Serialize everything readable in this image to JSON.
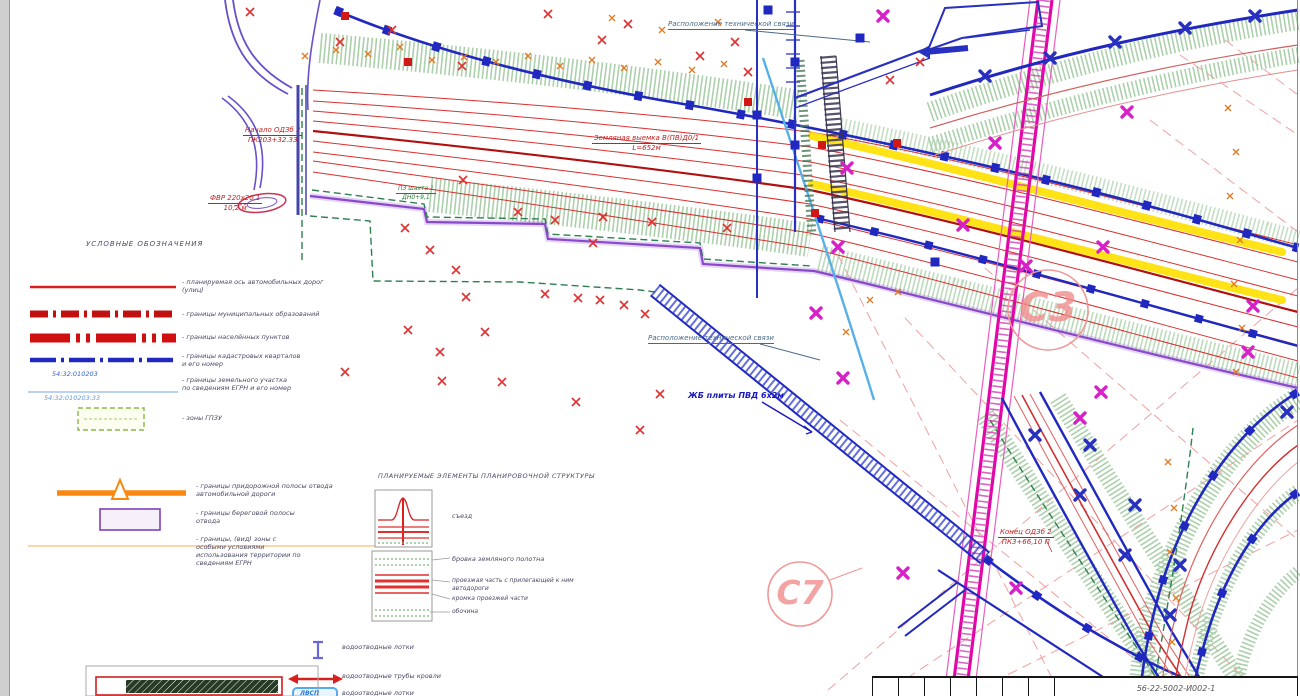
{
  "title_block": {
    "doc_number": "56-22-5002-И002-1"
  },
  "map": {
    "tech_top": "Расположение технической связи",
    "tech_mid": "Расположение технической связи",
    "start_a": "Начало ОДЗб 2",
    "start_b": "ПК203+32.33",
    "fvr_a": "ФВР 220х20,1",
    "fvr_b": "10,2 м",
    "shaft_a": "ПЗ шахта 1",
    "shaft_b": "ДН0+9,1",
    "exc_a": "Земляная выемка В(ПВ)Д0/1",
    "exc_b": "L=652м",
    "slabs": "ЖБ плиты ПВД 6х2м",
    "end_a": "Конец ОДЗб 2",
    "end_b": "ПК3+66,10 П",
    "zone_c3": "C3",
    "zone_c7": "C7"
  },
  "legend1": {
    "title": "УСЛОВНЫЕ ОБОЗНАЧЕНИЯ",
    "r1a": "- планируемая ось автомобильных дорог",
    "r1b": "(улиц)",
    "r2": "- границы муниципальных образований",
    "r3": "- границы населённых пунктов",
    "r4a": "- границы кадастровых кварталов",
    "r4b": "и его номер",
    "r5a": "- границы земельного участка",
    "r5b": "по  сведениям ЕГРН и его номер",
    "r6": "- зоны ГПЗУ",
    "cad_quarter": "54:32:010203",
    "cad_parcel": "54:32:010203:33"
  },
  "legend2": {
    "r1a": "- границы придорожной полосы отвода",
    "r1b": "автомобильной дороги",
    "r2a": "- границы береговой полосы",
    "r2b": "отвода",
    "r3a": "- границы, (вид) зоны с",
    "r3b": "особыми условиями",
    "r3c": "использования территории по",
    "r3d": "сведениям ЕГРН"
  },
  "legend3": {
    "title": "ПЛАНИРУЕМЫЕ ЭЛЕМЕНТЫ ПЛАНИРОВОЧНОЙ СТРУКТУРЫ",
    "exit": "съезд",
    "c0": "бровка земляного полотна",
    "c1": "проезжая часть с прилегающей к ним автодороги",
    "c2": "кромка проезжей части",
    "c3": "обочина"
  },
  "legend4": {
    "r1": "водоотводные лотки",
    "r2": "водоотводные трубы кровли",
    "r3": "водоотводные лотки",
    "box_text": "ЛВСП"
  },
  "colors": {
    "road_axis": "#b01010",
    "boundary_blue": "#2028c0",
    "magenta_road": "#e008a8",
    "closure_yellow": "#ffe20a",
    "hatch_green": "#9cc89c",
    "zone_circle": "#f09898"
  }
}
